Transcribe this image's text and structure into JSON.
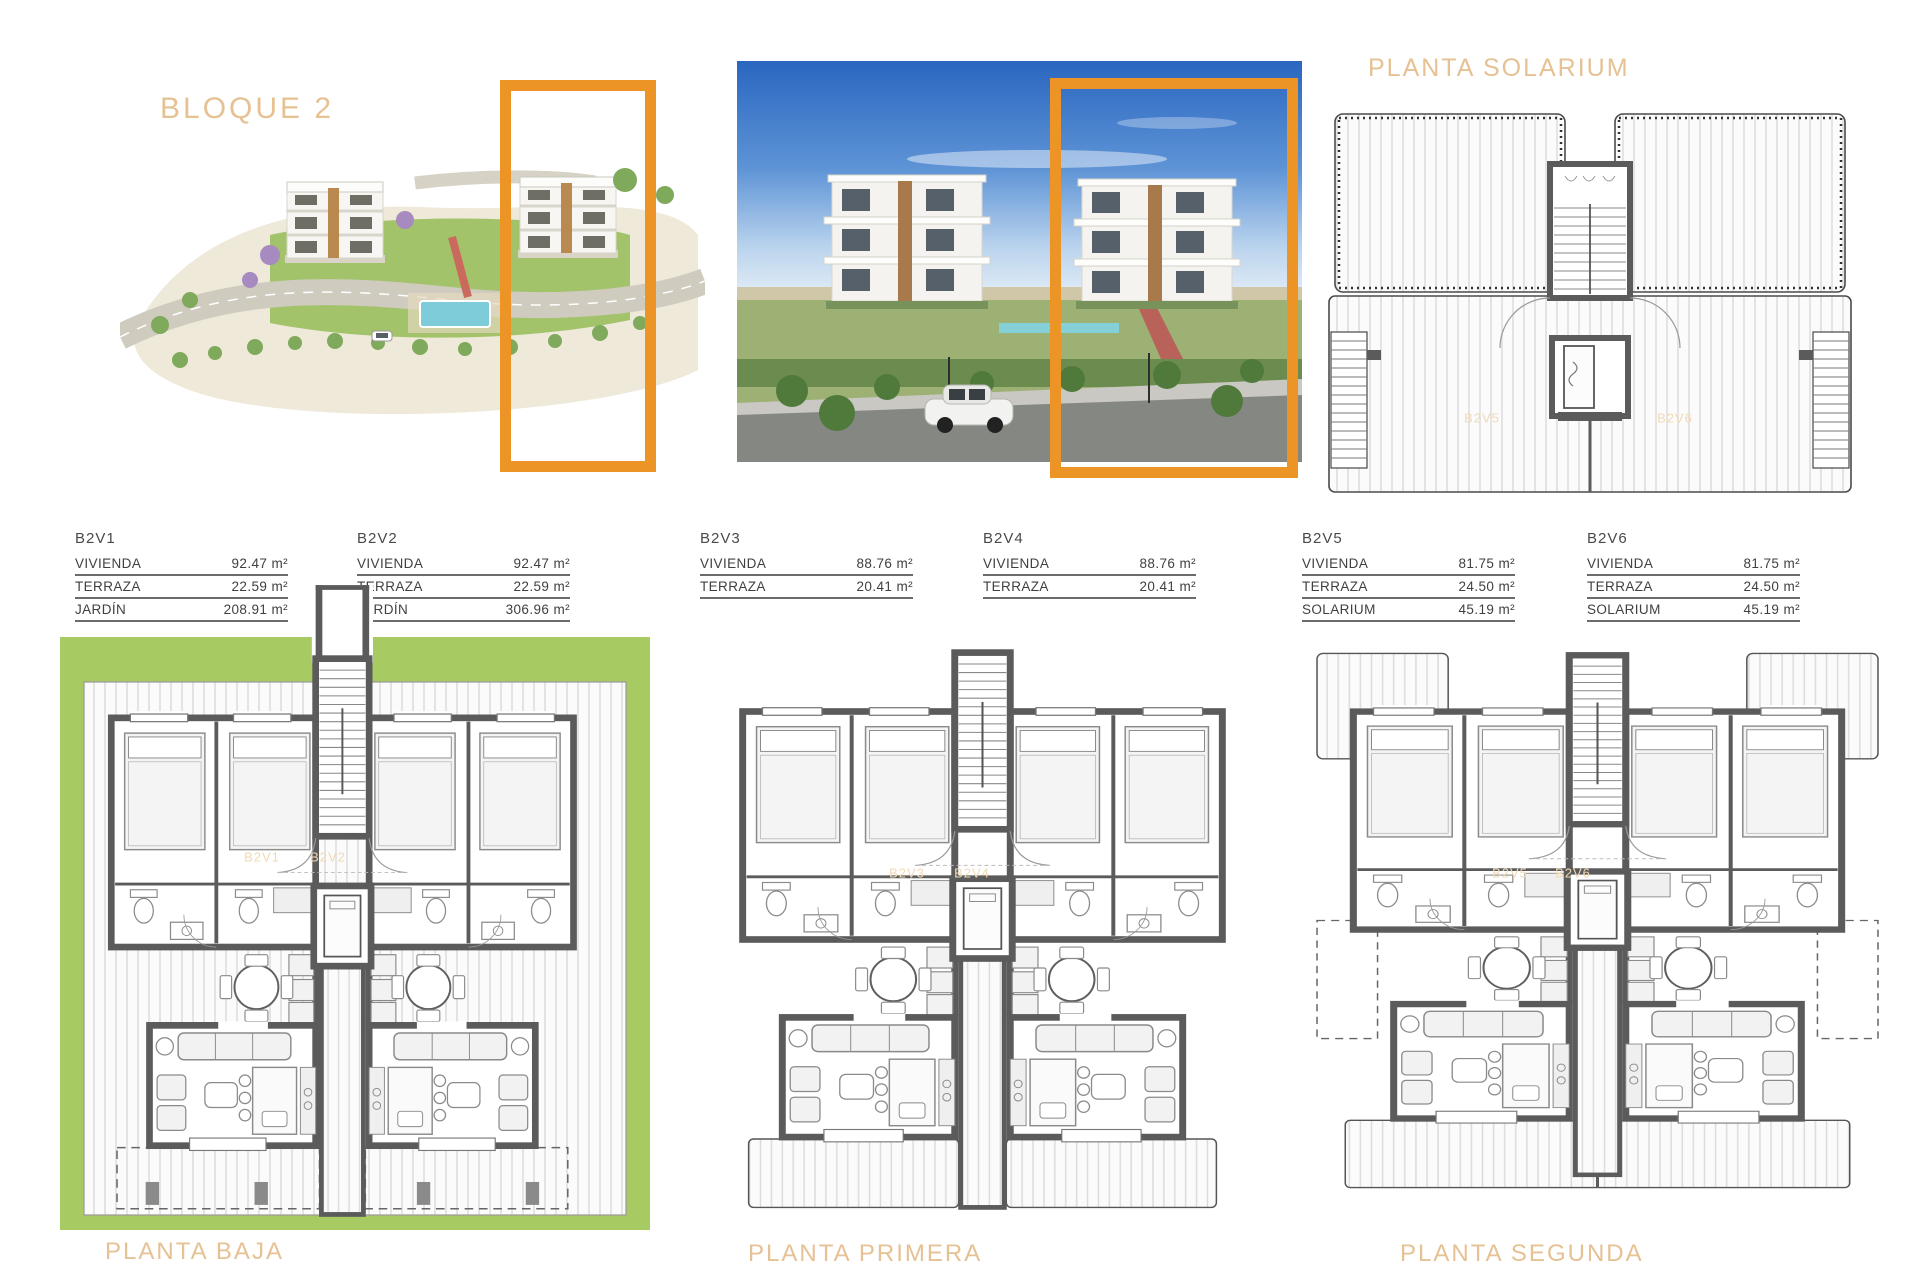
{
  "header": {
    "bloque_label": "BLOQUE 2"
  },
  "colors": {
    "highlight_orange": "#ec9526",
    "title_tan": "#e5c193",
    "faint_unit_label": "#f2d9b4",
    "garden_green": "#a8ca62",
    "wall_gray": "#5b5b5b"
  },
  "unit_tables": [
    {
      "name": "B2V1",
      "rows": [
        {
          "label": "VIVIENDA",
          "value": "92.47 m²"
        },
        {
          "label": "TERRAZA",
          "value": "22.59 m²"
        },
        {
          "label": "JARDÍN",
          "value": "208.91 m²"
        }
      ]
    },
    {
      "name": "B2V2",
      "rows": [
        {
          "label": "VIVIENDA",
          "value": "92.47 m²"
        },
        {
          "label": "TERRAZA",
          "value": "22.59 m²"
        },
        {
          "label": "JARDÍN",
          "value": "306.96 m²"
        }
      ]
    },
    {
      "name": "B2V3",
      "rows": [
        {
          "label": "VIVIENDA",
          "value": "88.76 m²"
        },
        {
          "label": "TERRAZA",
          "value": "20.41 m²"
        }
      ]
    },
    {
      "name": "B2V4",
      "rows": [
        {
          "label": "VIVIENDA",
          "value": "88.76 m²"
        },
        {
          "label": "TERRAZA",
          "value": "20.41 m²"
        }
      ]
    },
    {
      "name": "B2V5",
      "rows": [
        {
          "label": "VIVIENDA",
          "value": "81.75 m²"
        },
        {
          "label": "TERRAZA",
          "value": "24.50 m²"
        },
        {
          "label": "SOLARIUM",
          "value": "45.19 m²"
        }
      ]
    },
    {
      "name": "B2V6",
      "rows": [
        {
          "label": "VIVIENDA",
          "value": "81.75 m²"
        },
        {
          "label": "TERRAZA",
          "value": "24.50 m²"
        },
        {
          "label": "SOLARIUM",
          "value": "45.19 m²"
        }
      ]
    }
  ],
  "floor_plans": {
    "solarium": {
      "title": "PLANTA SOLARIUM",
      "unit_labels": [
        "B2V5",
        "B2V6"
      ]
    },
    "baja": {
      "title": "PLANTA BAJA",
      "unit_labels": [
        "B2V1",
        "B2V2"
      ]
    },
    "primera": {
      "title": "PLANTA PRIMERA",
      "unit_labels": [
        "B2V3",
        "B2V4"
      ]
    },
    "segunda": {
      "title": "PLANTA SEGUNDA",
      "unit_labels": [
        "B2V5",
        "B2V6"
      ]
    }
  }
}
